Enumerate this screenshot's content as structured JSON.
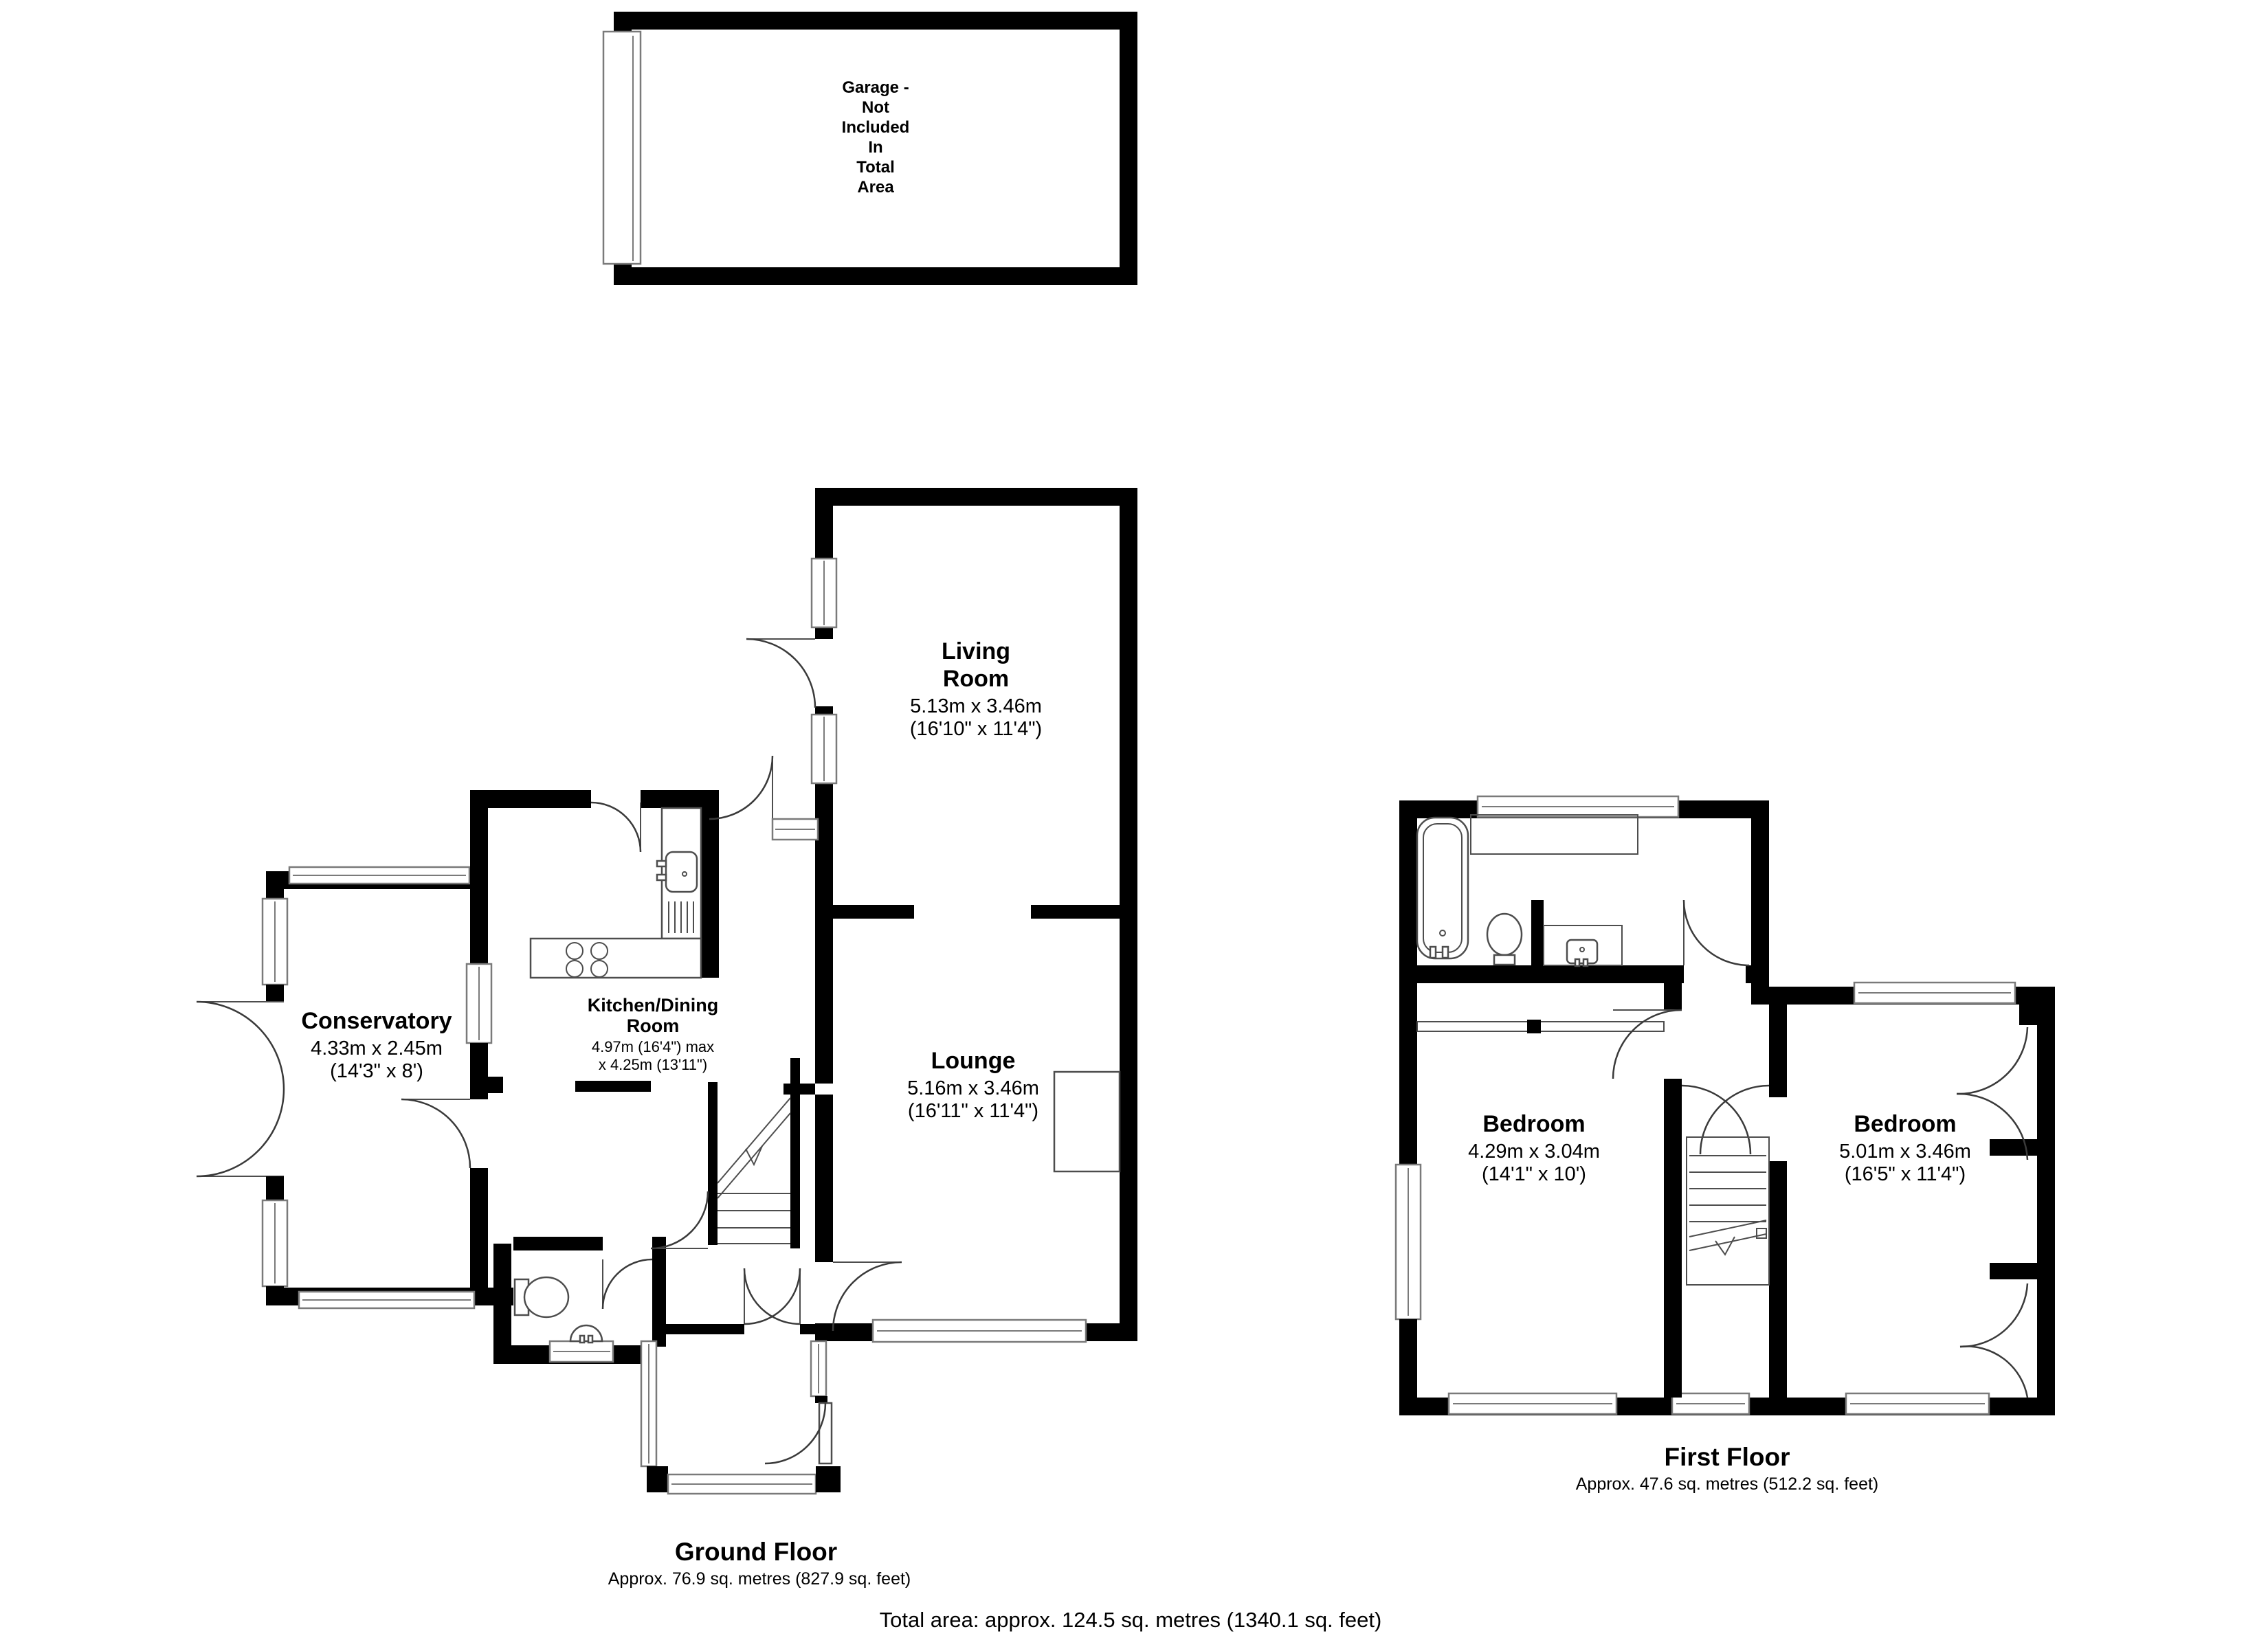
{
  "garage": {
    "label_lines": [
      "Garage -",
      "Not",
      "Included",
      "In",
      "Total",
      "Area"
    ]
  },
  "ground_floor": {
    "title": "Ground Floor",
    "area": "Approx. 76.9 sq. metres (827.9 sq. feet)",
    "rooms": {
      "living_room": {
        "name_line1": "Living",
        "name_line2": "Room",
        "dims_metric": "5.13m x 3.46m",
        "dims_imperial": "(16'10\" x 11'4\")"
      },
      "lounge": {
        "name": "Lounge",
        "dims_metric": "5.16m x 3.46m",
        "dims_imperial": "(16'11\" x 11'4\")"
      },
      "kitchen_dining": {
        "name_line1": "Kitchen/Dining",
        "name_line2": "Room",
        "dims_line1": "4.97m (16'4\") max",
        "dims_line2": "x 4.25m (13'11\")"
      },
      "conservatory": {
        "name": "Conservatory",
        "dims_metric": "4.33m x 2.45m",
        "dims_imperial": "(14'3\" x 8')"
      }
    }
  },
  "first_floor": {
    "title": "First Floor",
    "area": "Approx. 47.6 sq. metres (512.2 sq. feet)",
    "rooms": {
      "bedroom_left": {
        "name": "Bedroom",
        "dims_metric": "4.29m x 3.04m",
        "dims_imperial": "(14'1\" x 10')"
      },
      "bedroom_right": {
        "name": "Bedroom",
        "dims_metric": "5.01m x 3.46m",
        "dims_imperial": "(16'5\" x 11'4\")"
      }
    }
  },
  "totals": {
    "total_area": "Total area: approx. 124.5 sq. metres (1340.1 sq. feet)"
  }
}
